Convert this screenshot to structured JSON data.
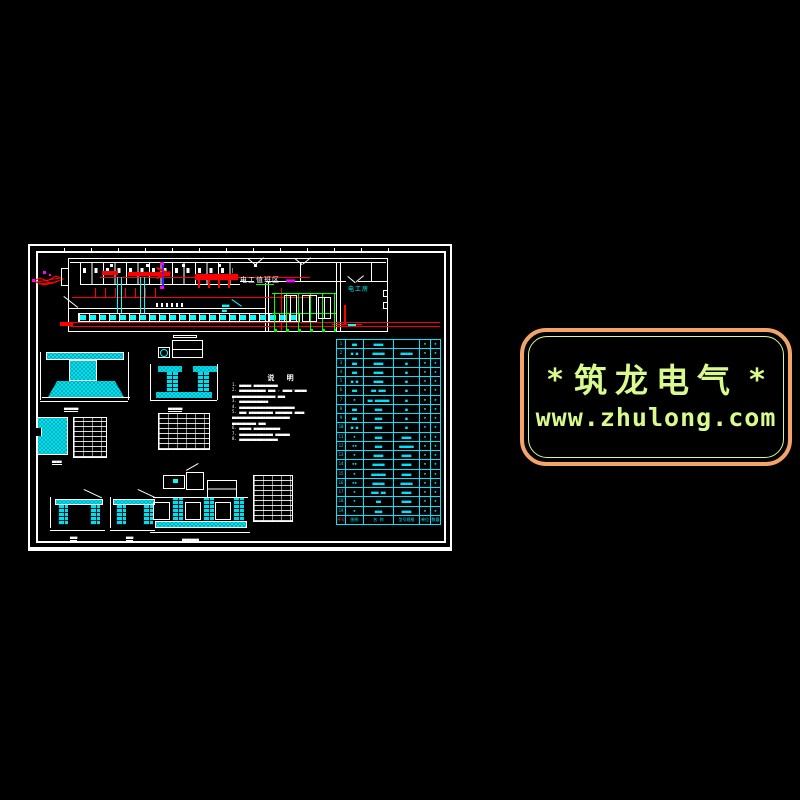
{
  "watermark": {
    "star_left": "*",
    "star_right": "*",
    "title": "筑龙电气",
    "url": "www.zhulong.com",
    "border_color": "#f2a469",
    "text_color": "#d9fa8e"
  },
  "floor_plan": {
    "label_duty_area": "电工值班区",
    "label_duty_suffix": "▄▄▄",
    "label_electric_room": "电工房",
    "leader_label_line1": "▄▄▄",
    "leader_label_line2": "▄▄"
  },
  "notes": {
    "title": "说 明",
    "lines": [
      "1. ▄▄▄▄▄ ▄▄▄▄▄▄▄▄▄▄",
      "2. ▄▄▄▄▄▄▄▄▄▄▄ ▄▄▄ , ▄▄▄▄-▄▄▄▄▄",
      "    ▄▄▄▄▄▄▄▄▄▄▄▄▄▄▄▄▄▄ ▄▄▄",
      "3. ▄▄▄▄▄▄▄▄▄▄▄▄",
      "4. ▄▄▄▄▄▄▄▄▄▄▄▄▄▄▄▄▄▄▄▄▄▄▄",
      "5. ▄▄▄ ▄▄▄▄▄▄▄▄▄▄ ▄▄▄▄▄▄▄ ▄▄▄▄",
      "    ▄▄▄▄▄▄▄▄▄▄▄▄▄▄▄▄▄▄▄▄▄▄▄▄",
      "    ▄▄▄▄▄▄▄▄▄▄ ▄▄▄",
      "6. ▄▄▄▄▄ ▄▄▄▄▄▄▄▄▄▄▄",
      "7. ▄▄▄▄▄▄▄▄▄▄▄▄▄▄ ▄▄▄▄▄▄",
      "8. ▄▄▄▄▄▄▄▄▄▄▄▄▄▄▄▄"
    ]
  },
  "details": {
    "caption_t_foundation": "▄▄▄▄▄▄",
    "caption_pad_plan": "▄▄▄▄",
    "caption_u_trench": "▄▄▄▄▄▄",
    "caption_trench_a": "▄▄▄",
    "caption_trench_b": "▄▄▄",
    "caption_section_c": "▄▄▄▄▄▄▄"
  },
  "equipment_table": {
    "header": [
      "序号",
      "图例",
      "名 称",
      "型号规格",
      "单位",
      "数量"
    ],
    "rows": [
      [
        "1",
        "▄▄",
        "▄▄▄▄",
        "",
        "▪",
        "▪"
      ],
      [
        "2",
        "▄ ▄",
        "▄▄▄▄▄",
        "▄▄▄▄▄",
        "▪",
        "▪"
      ],
      [
        "3",
        "▄▄",
        "▄▄▄▄",
        "▄",
        "▪",
        "▪"
      ],
      [
        "4",
        "▄▄",
        "▄▄▄▄",
        "▄",
        "▪",
        "▪"
      ],
      [
        "5",
        "▄ ▄",
        "▄▄▄▄",
        "▄",
        "▪",
        "▪"
      ],
      [
        "6",
        "▄▄",
        "▄▄ ▄▄▄",
        "▄",
        "▪",
        "▪"
      ],
      [
        "7",
        "▪",
        "▄▄ ▄▄▄▄▄▄",
        "▄",
        "▪",
        "▪"
      ],
      [
        "8",
        "▄▄",
        "▄▄▄",
        "▄",
        "▪",
        "▪"
      ],
      [
        "9",
        "▄▄",
        "▄▄▄",
        "▄",
        "▪",
        "▪"
      ],
      [
        "10",
        "▄ ▄",
        "▄▄▄",
        "▄",
        "▪",
        "▪"
      ],
      [
        "11",
        "▪",
        "▄▄▄",
        "▄▄▄▄",
        "▪",
        "▪"
      ],
      [
        "12",
        "▪▪",
        "▄▄▄",
        "▄▄▄▄▄▄",
        "▪",
        "▪"
      ],
      [
        "13",
        "▪",
        "▄▄▄▄",
        "▄▄▄▄",
        "▪",
        "▪"
      ],
      [
        "14",
        "▪▪",
        "▄▄▄▄▄",
        "▄▄▄▄",
        "▪",
        "▪"
      ],
      [
        "15",
        "▪",
        "▄▄▄▄▄▄",
        "▄▄▄▄",
        "▪",
        "▪"
      ],
      [
        "16",
        "▪▪",
        "▄▄▄▄▄",
        "▄▄▄▄▄",
        "▪",
        "▪"
      ],
      [
        "17",
        "▪",
        "▄▄▄ ▄▄",
        "▄▄▄▄",
        "▪",
        "▪"
      ],
      [
        "18",
        "▪",
        "▄▄",
        "▄▄▄▄",
        "▪",
        "▪"
      ],
      [
        "19",
        "▪",
        "▄▄▄",
        "▄▄▄▄",
        "▪",
        "▪"
      ]
    ]
  },
  "colors": {
    "background": "#000000",
    "line_white": "#ffffff",
    "line_red": "#ff0000",
    "line_cyan": "#00ffff",
    "line_green": "#00ff00",
    "line_magenta": "#ff00ff",
    "watermark_border": "#f2a469",
    "watermark_text": "#d9fa8e"
  }
}
